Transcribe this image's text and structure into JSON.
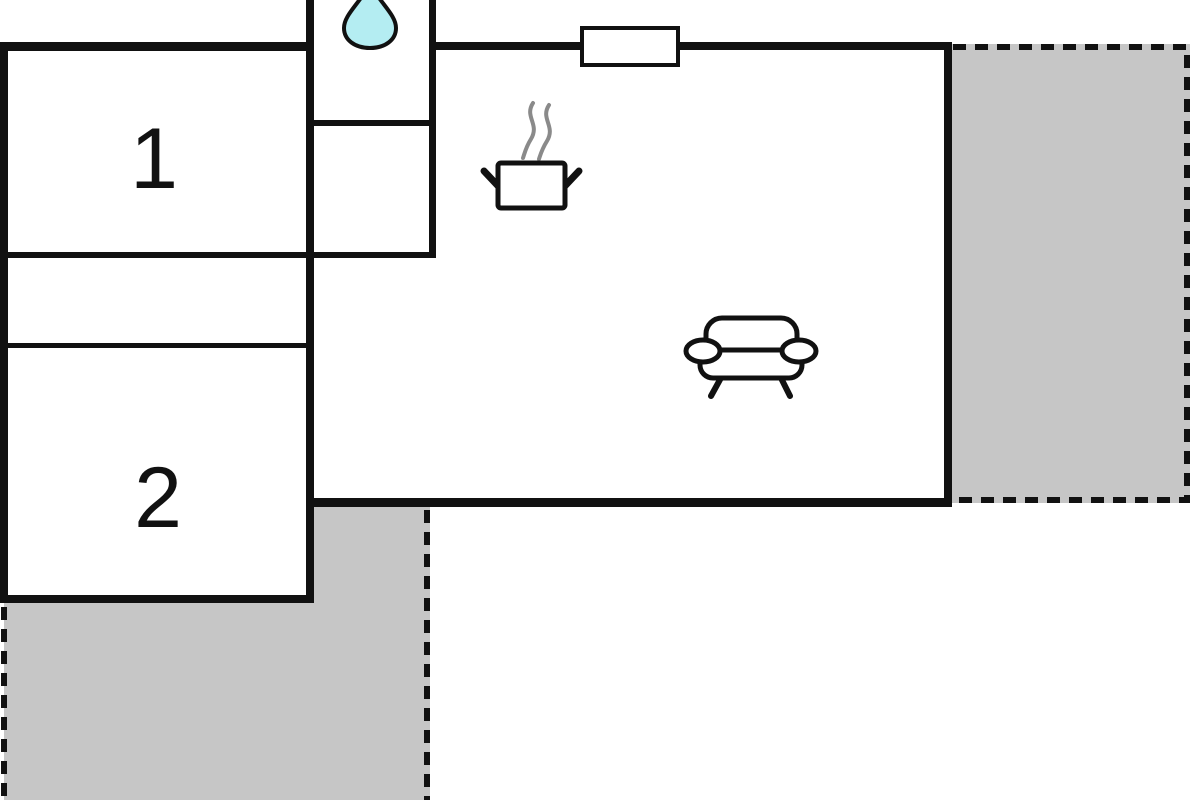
{
  "plan": {
    "rooms": [
      {
        "label": "1"
      },
      {
        "label": "2"
      }
    ],
    "icons": [
      "water-drop-icon",
      "stove-pot-icon",
      "sofa-icon",
      "window-icon"
    ],
    "colors": {
      "wall": "#111111",
      "terrace": "#c6c6c6",
      "water": "#b4edf2",
      "steam": "#8a8a8a",
      "background": "#ffffff"
    }
  }
}
